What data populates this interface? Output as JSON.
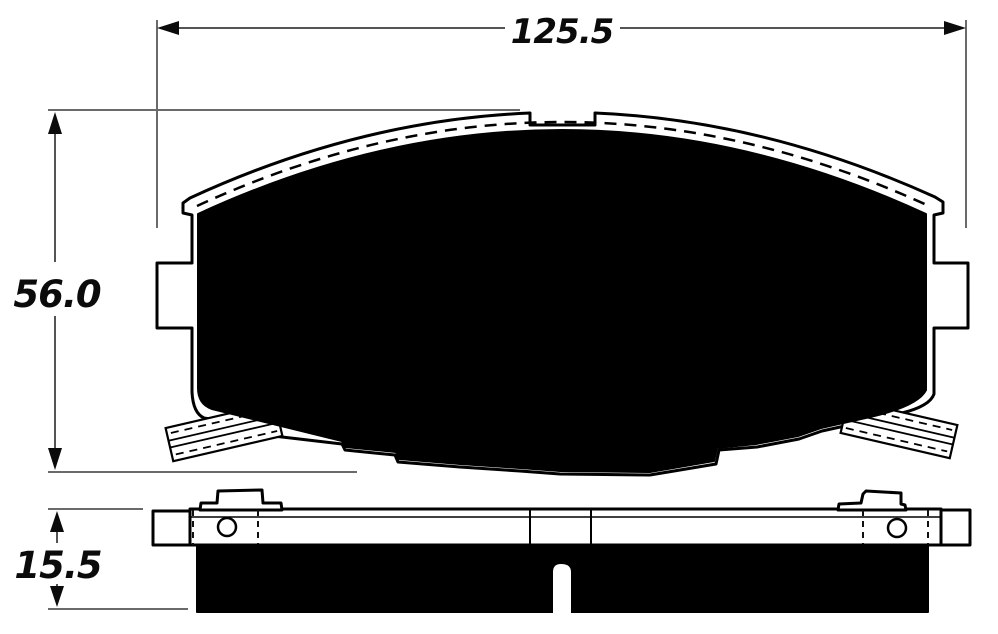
{
  "drawing": {
    "dimensions": {
      "width": "125.5",
      "height": "56.0",
      "thickness": "15.5"
    },
    "colors": {
      "ink": "#000000",
      "dimension_line": "#545454",
      "extension_line": "#6a6a6a",
      "background": "#ffffff"
    }
  }
}
